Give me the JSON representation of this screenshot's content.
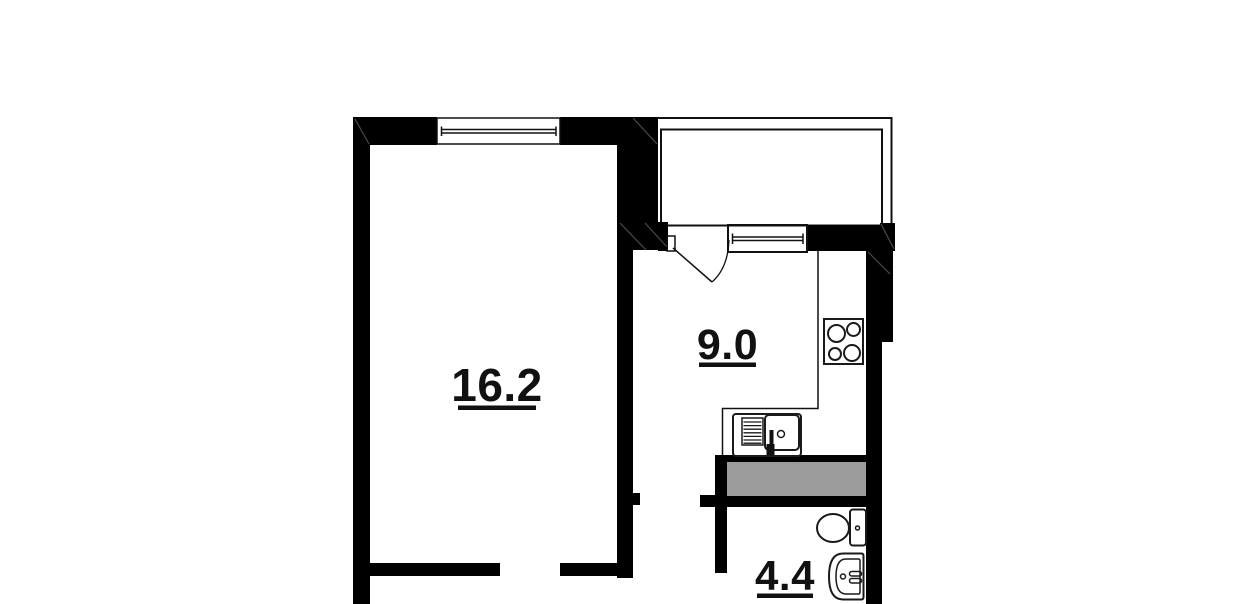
{
  "floor_plan": {
    "type": "apartment-floor-plan",
    "background": "#ffffff",
    "wall_color": "#000000",
    "line_color": "#1a1a1a",
    "shaft_fill": "#9b9b9b",
    "rooms": [
      {
        "name": "living-room",
        "area_label": "16.2"
      },
      {
        "name": "kitchen",
        "area_label": "9.0"
      },
      {
        "name": "bathroom",
        "area_label": "4.4"
      }
    ],
    "fixtures": [
      {
        "name": "stove-icon",
        "room": "kitchen"
      },
      {
        "name": "kitchen-sink-icon",
        "room": "kitchen"
      },
      {
        "name": "toilet-icon",
        "room": "bathroom"
      },
      {
        "name": "bathroom-sink-icon",
        "room": "bathroom"
      }
    ],
    "features": [
      {
        "name": "balcony"
      },
      {
        "name": "living-room-window"
      },
      {
        "name": "kitchen-window"
      },
      {
        "name": "kitchen-door-swing"
      },
      {
        "name": "ventilation-shaft"
      },
      {
        "name": "living-room-door-opening"
      },
      {
        "name": "hall-door-opening"
      }
    ]
  }
}
